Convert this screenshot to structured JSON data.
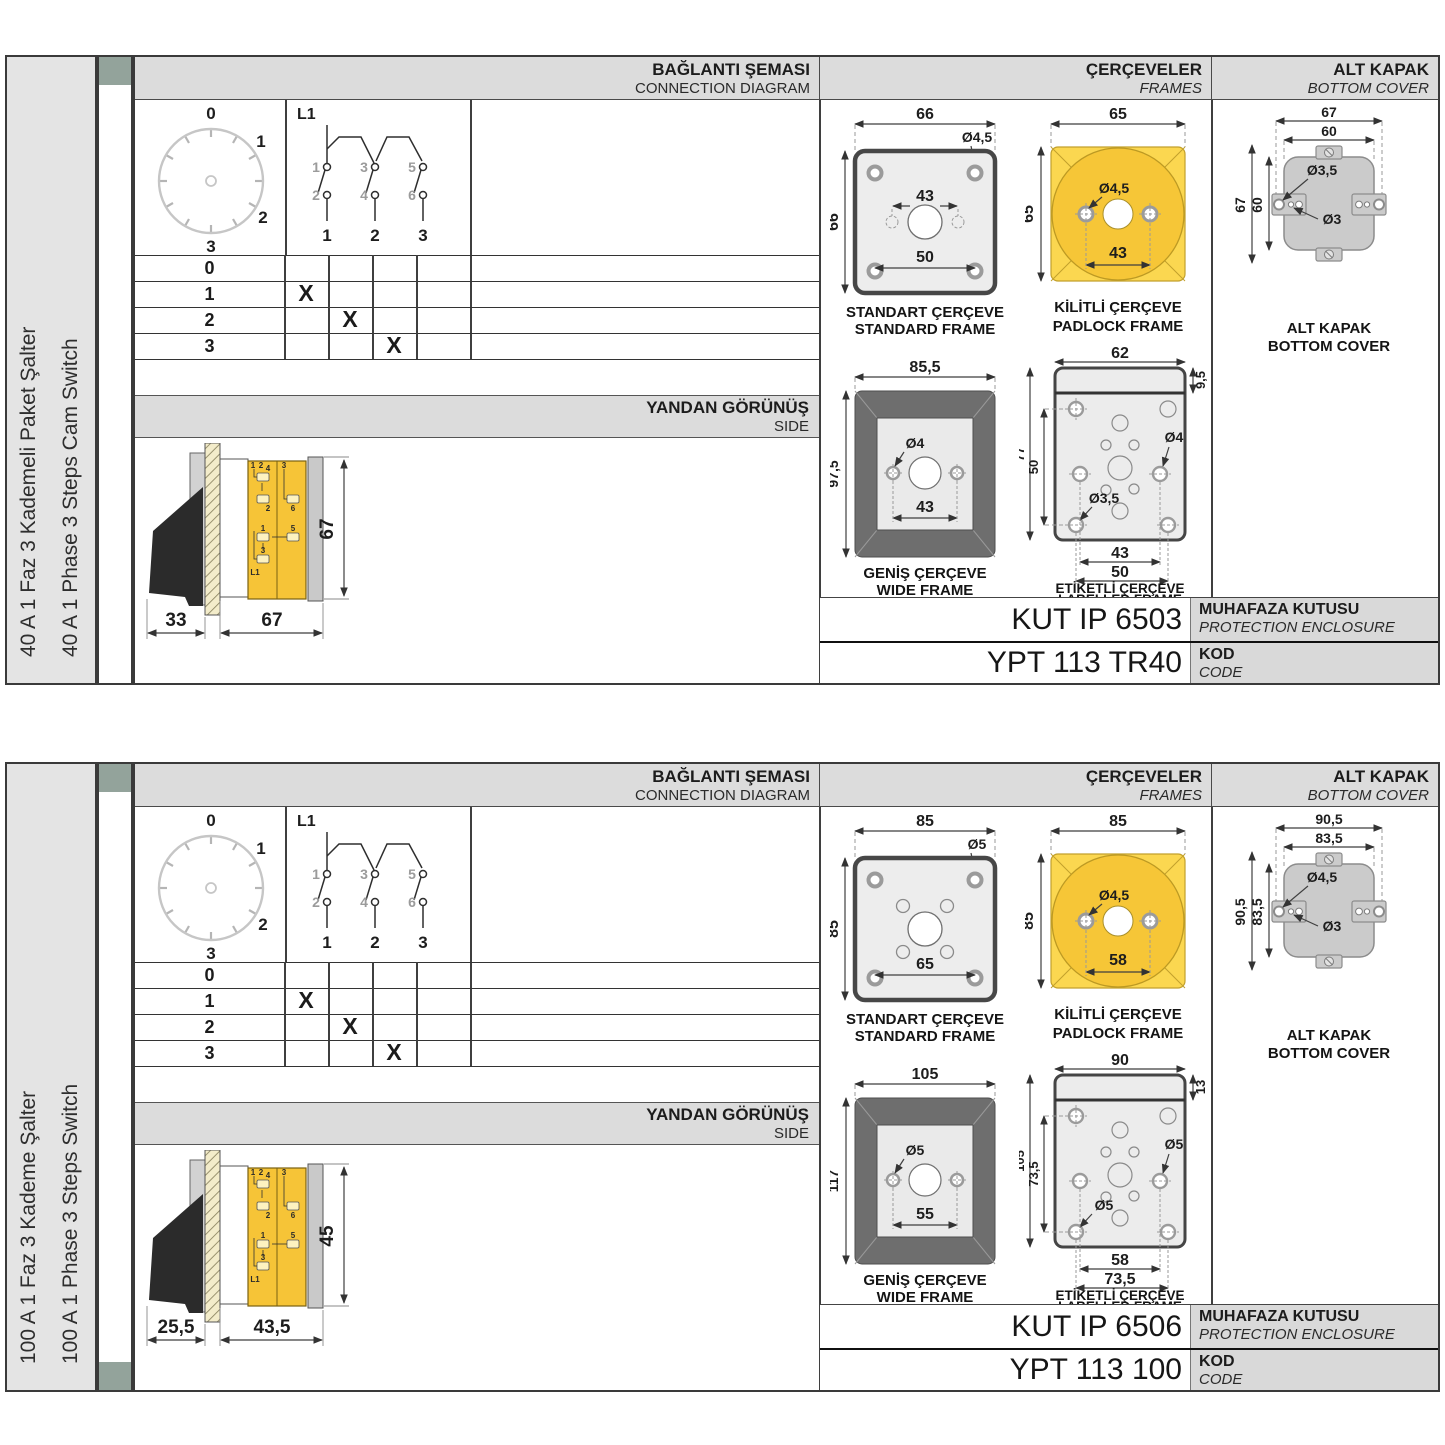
{
  "panels": [
    {
      "product_label_tr": "40 A 1 Faz 3 Kademeli Paket Şalter",
      "product_label_en": "40 A 1 Phase 3 Steps Cam Switch",
      "headers": {
        "connection_tr": "BAĞLANTI ŞEMASI",
        "connection_en": "CONNECTION DIAGRAM",
        "frames_tr": "ÇERÇEVELER",
        "frames_en": "FRAMES",
        "cover_tr": "ALT KAPAK",
        "cover_en": "BOTTOM COVER"
      },
      "dial": {
        "pos0": "0",
        "pos1": "1",
        "pos2": "2",
        "pos3": "3"
      },
      "circuit": {
        "line": "L1",
        "c1": "1",
        "c2": "2",
        "c3": "3",
        "c4": "4",
        "c5": "5",
        "c6": "6",
        "out1": "1",
        "out2": "2",
        "out3": "3"
      },
      "table": {
        "rows": [
          {
            "pos": "0",
            "m1": "",
            "m2": "",
            "m3": ""
          },
          {
            "pos": "1",
            "m1": "X",
            "m2": "",
            "m3": ""
          },
          {
            "pos": "2",
            "m1": "",
            "m2": "X",
            "m3": ""
          },
          {
            "pos": "3",
            "m1": "",
            "m2": "",
            "m3": "X"
          }
        ]
      },
      "side_view": {
        "title_tr": "YANDAN GÖRÜNÜŞ",
        "title_en": "SIDE",
        "dim_depth_handle": "33",
        "dim_depth_body": "67",
        "dim_height": "67",
        "term": {
          "a": "1",
          "b": "2",
          "c": "4",
          "d": "2",
          "e": "3",
          "f": "6",
          "g": "1",
          "h": "5",
          "i": "3",
          "j": "L1"
        }
      },
      "frames": {
        "standard": {
          "label_tr": "STANDART ÇERÇEVE",
          "label_en": "STANDARD FRAME",
          "dim_width": "66",
          "dim_height": "66",
          "hole": "Ø4,5",
          "dim_inner": "43",
          "dim_outer": "50"
        },
        "padlock": {
          "label_tr": "KİLİTLİ ÇERÇEVE",
          "label_en": "PADLOCK FRAME",
          "dim_width": "65",
          "dim_height": "65",
          "hole": "Ø4,5",
          "dim_holes": "43"
        },
        "wide": {
          "label_tr": "GENİŞ ÇERÇEVE",
          "label_en": "WIDE FRAME",
          "dim_width": "85,5",
          "dim_height": "97,5",
          "hole": "Ø4",
          "dim_holes": "43"
        },
        "labelled": {
          "label_tr": "ETİKETLİ ÇERÇEVE",
          "label_en": "LABELLED FRAME",
          "dim_width": "62",
          "dim_strip": "9,5",
          "dim_height": "77",
          "dim_inner_v": "50",
          "hole_big": "Ø4",
          "hole_small": "Ø3,5",
          "dim_bottom1": "43",
          "dim_bottom2": "50"
        }
      },
      "cover": {
        "label_tr": "ALT KAPAK",
        "label_en": "BOTTOM COVER",
        "dim_w_outer": "67",
        "dim_w_inner": "60",
        "dim_h_outer": "67",
        "dim_h_inner": "60",
        "hole_tab": "Ø3,5",
        "hole_small": "Ø3"
      },
      "codes": {
        "enclosure_value": "KUT IP 6503",
        "enclosure_tr": "MUHAFAZA KUTUSU",
        "enclosure_en": "PROTECTION ENCLOSURE",
        "code_value": "YPT 113 TR40",
        "code_tr": "KOD",
        "code_en": "CODE"
      }
    },
    {
      "product_label_tr": "100 A 1 Faz 3 Kademe Şalter",
      "product_label_en": "100 A 1 Phase 3 Steps Switch",
      "headers": {
        "connection_tr": "BAĞLANTI ŞEMASI",
        "connection_en": "CONNECTION DIAGRAM",
        "frames_tr": "ÇERÇEVELER",
        "frames_en": "FRAMES",
        "cover_tr": "ALT KAPAK",
        "cover_en": "BOTTOM COVER"
      },
      "dial": {
        "pos0": "0",
        "pos1": "1",
        "pos2": "2",
        "pos3": "3"
      },
      "circuit": {
        "line": "L1",
        "c1": "1",
        "c2": "2",
        "c3": "3",
        "c4": "4",
        "c5": "5",
        "c6": "6",
        "out1": "1",
        "out2": "2",
        "out3": "3"
      },
      "table": {
        "rows": [
          {
            "pos": "0",
            "m1": "",
            "m2": "",
            "m3": ""
          },
          {
            "pos": "1",
            "m1": "X",
            "m2": "",
            "m3": ""
          },
          {
            "pos": "2",
            "m1": "",
            "m2": "X",
            "m3": ""
          },
          {
            "pos": "3",
            "m1": "",
            "m2": "",
            "m3": "X"
          }
        ]
      },
      "side_view": {
        "title_tr": "YANDAN GÖRÜNÜŞ",
        "title_en": "SIDE",
        "dim_depth_handle": "25,5",
        "dim_depth_body": "43,5",
        "dim_height": "45",
        "term": {
          "a": "1",
          "b": "2",
          "c": "4",
          "d": "2",
          "e": "3",
          "f": "6",
          "g": "1",
          "h": "5",
          "i": "3",
          "j": "L1"
        }
      },
      "frames": {
        "standard": {
          "label_tr": "STANDART ÇERÇEVE",
          "label_en": "STANDARD FRAME",
          "dim_width": "85",
          "dim_height": "85",
          "hole": "Ø5",
          "dim_outer": "65"
        },
        "padlock": {
          "label_tr": "KİLİTLİ ÇERÇEVE",
          "label_en": "PADLOCK FRAME",
          "dim_width": "85",
          "dim_height": "85",
          "hole": "Ø4,5",
          "dim_holes": "58"
        },
        "wide": {
          "label_tr": "GENİŞ ÇERÇEVE",
          "label_en": "WIDE FRAME",
          "dim_width": "105",
          "dim_height": "117",
          "hole": "Ø5",
          "dim_holes": "55"
        },
        "labelled": {
          "label_tr": "ETİKETLİ ÇERÇEVE",
          "label_en": "LABELLED FRAME",
          "dim_width": "90",
          "dim_strip": "13",
          "dim_height": "105",
          "dim_inner_v": "73,5",
          "hole_big": "Ø5",
          "hole_small": "Ø5",
          "dim_bottom1": "58",
          "dim_bottom2": "73,5"
        }
      },
      "cover": {
        "label_tr": "ALT KAPAK",
        "label_en": "BOTTOM COVER",
        "dim_w_outer": "90,5",
        "dim_w_inner": "83,5",
        "dim_h_outer": "90,5",
        "dim_h_inner": "83,5",
        "hole_tab": "Ø4,5",
        "hole_small": "Ø3"
      },
      "codes": {
        "enclosure_value": "KUT IP 6506",
        "enclosure_tr": "MUHAFAZA KUTUSU",
        "enclosure_en": "PROTECTION ENCLOSURE",
        "code_value": "YPT 113 100",
        "code_tr": "KOD",
        "code_en": "CODE"
      }
    }
  ],
  "colors": {
    "accent_yellow": "#F6C637",
    "panel_gray": "#DCDCDC",
    "tab_green": "#93A39B"
  }
}
